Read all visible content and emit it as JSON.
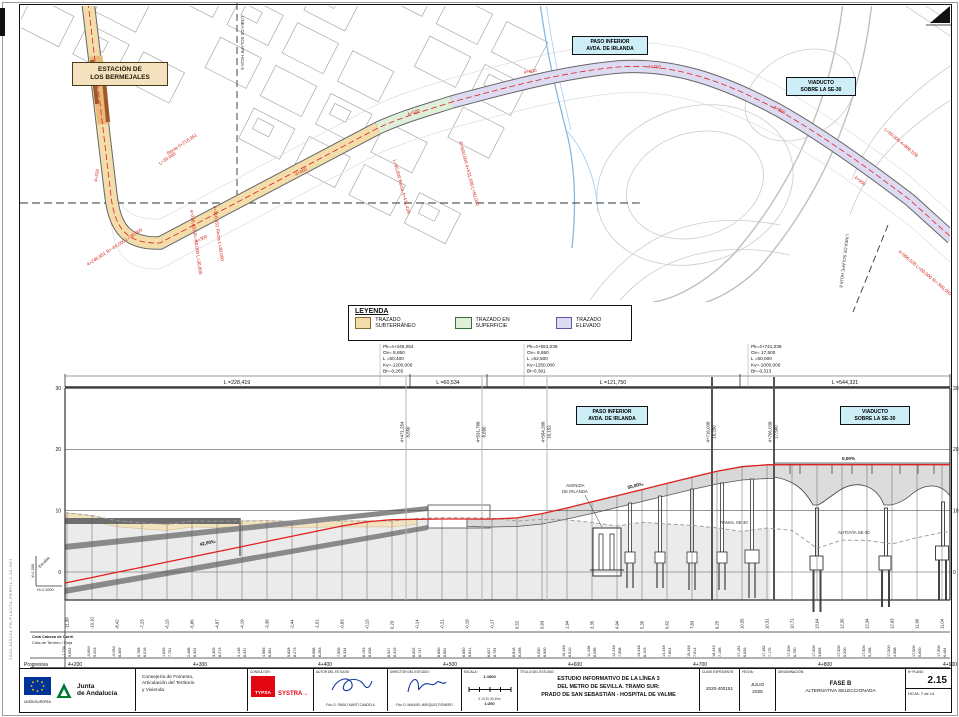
{
  "sheet": {
    "code_left": "2020-400151-FB-PLANTA-PERFIL-2.15-H07",
    "north_icon": "north-arrow"
  },
  "plan": {
    "station": {
      "line1": "ESTACIÓN DE",
      "line2": "LOS BERMEJALES"
    },
    "paso_box": {
      "line1": "PASO INFERIOR",
      "line2": "AVDA. DE IRLANDA"
    },
    "viaducto_box": {
      "line1": "VIADUCTO",
      "line2": "SOBRE LA SE-30"
    },
    "overlap_left": "LÍNEA DE SOLAPE HOJA 6",
    "overlap_right": "LÍNEA DE SOLAPE HOJA 8",
    "annotations": [
      {
        "t": "4+200",
        "x": 97,
        "y": 182,
        "r": -80
      },
      {
        "t": "Recta 4+216,951",
        "x": 168,
        "y": 155,
        "r": -33
      },
      {
        "t": "L=30,000",
        "x": 160,
        "y": 165,
        "r": -33
      },
      {
        "t": "4+256,951 R=-60,000 L=30,000",
        "x": 190,
        "y": 210,
        "r": 82
      },
      {
        "t": "4+316,951 Recta L=30,000",
        "x": 213,
        "y": 206,
        "r": 82
      },
      {
        "t": "4+246,951 R=-64,000 L=30,000",
        "x": 88,
        "y": 266,
        "r": -33
      },
      {
        "t": "4+300",
        "x": 196,
        "y": 243,
        "r": -25
      },
      {
        "t": "4+400",
        "x": 296,
        "y": 176,
        "r": -28
      },
      {
        "t": "L=60,000 Recta 4+471,439",
        "x": 393,
        "y": 160,
        "r": 75
      },
      {
        "t": "R=600,000 4+531,438 L=60,000",
        "x": 459,
        "y": 142,
        "r": 75
      },
      {
        "t": "4+500",
        "x": 408,
        "y": 116,
        "r": -20
      },
      {
        "t": "4+600",
        "x": 524,
        "y": 74,
        "r": -10
      },
      {
        "t": "4+700",
        "x": 648,
        "y": 68,
        "r": 3
      },
      {
        "t": "4+800",
        "x": 773,
        "y": 108,
        "r": 28
      },
      {
        "t": "4+900",
        "x": 854,
        "y": 178,
        "r": 38
      },
      {
        "t": "L=60,000 4+866,528",
        "x": 884,
        "y": 130,
        "r": 40
      },
      {
        "t": "4+966,528 L=60,000 R=-300,000",
        "x": 898,
        "y": 252,
        "r": 40
      }
    ]
  },
  "legend": {
    "title": "LEYENDA",
    "items": [
      {
        "label": "TRAZADO SUBTERRÁNEO",
        "fill": "#f2ddab",
        "border": "#8a6a30"
      },
      {
        "label": "TRAZADO EN SUPERFICIE",
        "fill": "#dff0da",
        "border": "#3a6b3a"
      },
      {
        "label": "TRAZADO ELEVADO",
        "fill": "#dddbf2",
        "border": "#5a5a9a"
      }
    ]
  },
  "profile": {
    "paso_box": {
      "line1": "PASO INFERIOR",
      "line2": "AVDA. DE IRLANDA"
    },
    "viaducto_box": {
      "line1": "VIADUCTO",
      "line2": "SOBRE LA SE-30"
    },
    "axis_elevations": [
      [
        30,
        388.1
      ],
      [
        20,
        449.4
      ],
      [
        10,
        510.7
      ],
      [
        0,
        572
      ]
    ],
    "ruler_labels": [
      {
        "t": "L =228,419",
        "cx": 237
      },
      {
        "t": "L =60,534",
        "cx": 448
      },
      {
        "t": "L =121,750",
        "cx": 613
      },
      {
        "t": "L =544,321",
        "cx": 845
      }
    ],
    "ruler_ticks": [
      65,
      410,
      487,
      740,
      950
    ],
    "vc_blocks": [
      {
        "x": 383,
        "lines": [
          "Pk=4+446,054",
          "Ov=  8,650",
          "L =50,400",
          "Kv=-1200,000",
          "Bi=-0,265"
        ]
      },
      {
        "x": 527,
        "lines": [
          "Pk=4+553,038",
          "Ov=  8,650",
          "L =62,500",
          "Kv=1250,000",
          "Bi=0,391"
        ]
      },
      {
        "x": 751,
        "lines": [
          "Pk=4+741,038",
          "Ov= 17,500",
          "L =50,000",
          "Kv=-1000,000",
          "Bi=-0,313"
        ]
      }
    ],
    "vc_ordinates": [
      {
        "x": 406,
        "pk": "4+471,254",
        "e": "8,650",
        "heavy": 0
      },
      {
        "x": 482,
        "pk": "4+531,788",
        "e": "8,650",
        "heavy": 0
      },
      {
        "x": 547,
        "pk": "4+584,288",
        "e": "10,152",
        "heavy": 0
      },
      {
        "x": 712,
        "pk": "4+716,038",
        "e": "16,250",
        "heavy": 1
      },
      {
        "x": 774,
        "pk": "4+766,038",
        "e": "17,500",
        "heavy": 1
      }
    ],
    "slope_labels": [
      {
        "t": "42,00‰",
        "x": 200,
        "y": 546,
        "r": -12
      },
      {
        "t": "50,00‰",
        "x": 628,
        "y": 489,
        "r": -14
      },
      {
        "t": "0,00%",
        "x": 842,
        "y": 460,
        "r": 0
      }
    ],
    "struct_labels": [
      {
        "t": "AVENIDA",
        "x": 566,
        "y": 487
      },
      {
        "t": "DE IRLANDA",
        "x": 562,
        "y": 493
      },
      {
        "t": "RAMAL SE-30",
        "x": 720,
        "y": 524
      },
      {
        "t": "AUTOVÍA SE-30",
        "x": 838,
        "y": 534
      }
    ],
    "row_labels": {
      "carril": "Cota Cabeza de Carril",
      "terreno": "Cota de Terreno / Roja",
      "progresiva": "Progresiva"
    },
    "scale_note": {
      "v": "V=1:200",
      "h": "H=1:1000",
      "word": "Escalas"
    }
  },
  "chart_data": {
    "type": "line",
    "title": "Perfil longitudinal - Línea 3 Metro de Sevilla (tramo 4+200 a 4+900)",
    "xlabel": "Progresiva",
    "ylabel": "Cota (m)",
    "ylim": [
      0,
      30
    ],
    "x_start": 4200,
    "x_step": 20,
    "series": [
      {
        "name": "Cota Cabeza de Carril",
        "values": [
          -1.734,
          -0.894,
          -0.054,
          0.788,
          1.626,
          2.468,
          3.305,
          4.148,
          4.986,
          5.828,
          6.668,
          7.506,
          8.193,
          8.547,
          8.602,
          8.65,
          8.65,
          8.627,
          8.818,
          9.53,
          10.448,
          11.448,
          12.448,
          13.448,
          14.448,
          15.448,
          16.443,
          17.181,
          17.482,
          17.5,
          17.5,
          17.5,
          17.5,
          17.5,
          17.5,
          17.5
        ]
      },
      {
        "name": "Cota de Terreno",
        "values": [
          9.652,
          9.203,
          8.369,
          8.018,
          7.761,
          8.324,
          8.273,
          8.337,
          8.361,
          8.273,
          8.283,
          8.334,
          8.328,
          8.319,
          8.747,
          8.861,
          8.841,
          8.794,
          8.298,
          8.6,
          8.51,
          8.098,
          7.508,
          8.103,
          7.824,
          7.614,
          7.198,
          6.628,
          7.175,
          6.79,
          3.859,
          5.2,
          5.158,
          4.568,
          5.6,
          6.464
        ]
      }
    ],
    "gradients": [
      "42,00‰",
      "50,00‰",
      "0,00%"
    ]
  },
  "title_block": {
    "eu_caption": "UNIÓN EUROPEA",
    "junta1": "Junta",
    "junta2": "de Andalucía",
    "consejeria1": "Consejería de Fomento,",
    "consejeria2": "Articulación del Territorio",
    "consejeria3": "y Vivienda",
    "consultor_header": "CONSULTOR:",
    "typsa": "TYPSA",
    "systra": "SYSTRA",
    "autor_header": "AUTOR DEL ESTUDIO:",
    "autor": "Fdo: D. PABLO MARTÍ CANDELA",
    "director_header": "DIRECTOR DEL ESTUDIO:",
    "director": "Fdo: D. MANUEL MÁRQUEZ ROMERO",
    "escala_header": "ESCALA:",
    "escala1": "1:1000",
    "escala1_ticks": "0    10    20    30    40m",
    "escala2": "1:200",
    "escala2_ticks": "0      2      4m",
    "formato": "FORMATO ORIGINAL UNE-A1",
    "titulo_header": "TÍTULO DEL ESTUDIO:",
    "titulo1": "ESTUDIO INFORMATIVO DE LA LÍNEA 3",
    "titulo2": "DEL METRO DE SEVILLA. TRAMO SUR:",
    "titulo3": "PRADO DE SAN SEBASTIÁN - HOSPITAL DE VALME",
    "clave_header": "CLAVE EXPEDIENTE:",
    "clave": "2020-400151",
    "fecha_header": "FECHA:",
    "fecha1": "JULIO",
    "fecha2": "2025",
    "denominacion_header": "DENOMINACIÓN:",
    "denominacion1": "FASE B",
    "denominacion2": "ALTERNATIVA SELECCIONADA",
    "plano_header": "Nº PLANO:",
    "plano": "2.15",
    "hoja_header": "HOJA:",
    "hoja": "7 de 14"
  }
}
